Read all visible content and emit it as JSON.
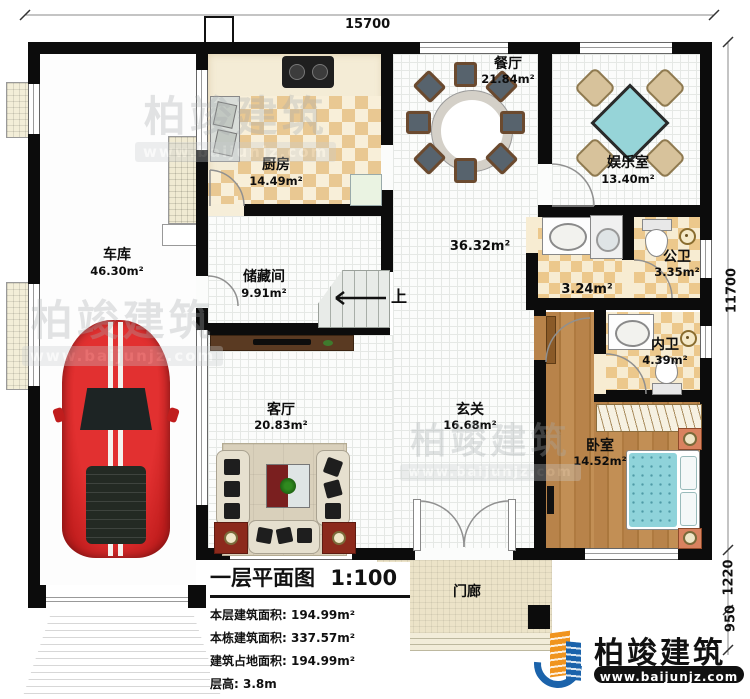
{
  "dimensions": {
    "top": "15700",
    "right_main": "11700",
    "right_porch": "1220",
    "right_steps": "950"
  },
  "rooms": {
    "garage": {
      "name": "车库",
      "area": "46.30m²"
    },
    "kitchen": {
      "name": "厨房",
      "area": "14.49m²"
    },
    "dining": {
      "name": "餐厅",
      "area": "21.84m²"
    },
    "entertainment": {
      "name": "娱乐室",
      "area": "13.40m²"
    },
    "hall": {
      "area": "36.32m²"
    },
    "storage": {
      "name": "储藏间",
      "area": "9.91m²"
    },
    "wash": {
      "area": "3.24m²"
    },
    "public_bath": {
      "name": "公卫",
      "area": "3.35m²"
    },
    "private_bath": {
      "name": "内卫",
      "area": "4.39m²"
    },
    "living": {
      "name": "客厅",
      "area": "20.83m²"
    },
    "foyer": {
      "name": "玄关",
      "area": "16.68m²"
    },
    "bedroom": {
      "name": "卧室",
      "area": "14.52m²"
    },
    "porch": {
      "name": "门廊"
    }
  },
  "stairs": {
    "up_label": "上"
  },
  "info_block": {
    "title": "一层平面图",
    "scale": "1:100",
    "lines": [
      "本层建筑面积: 194.99m²",
      "本栋建筑面积: 337.57m²",
      "建筑占地面积: 194.99m²",
      "层高: 3.8m"
    ]
  },
  "brand": {
    "name": "柏竣建筑",
    "url": "www.baijunjz.com"
  },
  "watermark": {
    "name": "柏竣建筑",
    "url": "www.baijunjz.com"
  },
  "colors": {
    "accent_blue": "#1b63ab",
    "accent_orange": "#f0941f",
    "bed_teal": "#8fd3da"
  }
}
